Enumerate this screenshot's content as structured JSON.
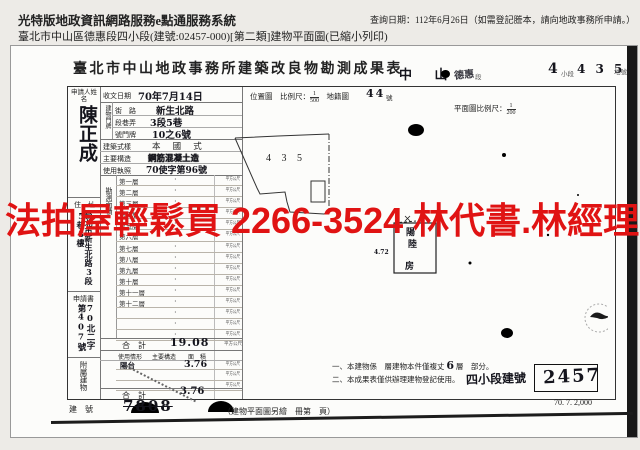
{
  "header": {
    "system_name": "光特版地政資訊網路服務e點通服務系統",
    "query_note": "查詢日期：112年6月26日（如需登記謄本，請向地政事務所申請。）",
    "doc_desc": "臺北市中山區德惠段四小段(建號:02457-000)[第二類]建物平面圖(已縮小列印)"
  },
  "watermark": {
    "text": "法拍屋輕鬆買  2266-3524  林代書.林經理",
    "color": "#e01313"
  },
  "form": {
    "title": "臺北市中山地政事務所建築改良物勘測成果表",
    "title_hand1": "中 山",
    "title_hand2": "德惠",
    "title_hand3": "段",
    "title_stamp_num1": "4",
    "title_stamp_mid": "小段",
    "title_stamp_num2": "4 3 5",
    "title_stamp_suffix": "地號",
    "applicant_label": "申請人姓名",
    "applicant_name": "陳正成",
    "address_label": "住　址",
    "address_value": "台北市新生北路3段5巷3樓",
    "application_label": "申請書",
    "application_no": "70北二字第407號",
    "annex_side_label": "附屬建物",
    "received_label": "收文日期",
    "received_value": "70年7月14日",
    "location_label": "位置圖　比例尺：",
    "location_num": "1",
    "location_den": "500",
    "map_label": "地籍圖",
    "map_no": "44",
    "map_suffix": "號",
    "plan_scale_label": "平面圖比例尺：",
    "plan_scale_num": "1",
    "plan_scale_den": "200",
    "door": {
      "group_label": "建物門牌",
      "street_label": "街　路",
      "street_value": "新生北路",
      "lane_label": "段巷弄",
      "lane_value": "3段5巷",
      "number_label": "號門牌",
      "number_value": "10之6號"
    },
    "style_label": "建築式樣",
    "style_value": "本 國 式",
    "structure_label": "主要構造",
    "structure_value": "鋼筋混凝土造",
    "license_label": "使用執照",
    "license_value": "70使字第96號",
    "area_side_label": "勘測面積",
    "floor_unit": "平方公尺",
    "floors": [
      "第一層",
      "第二層",
      "第三層",
      "第四層",
      "第五層",
      "第六層",
      "第七層",
      "第八層",
      "第九層",
      "第十層",
      "第十一層",
      "第十二層",
      "",
      "",
      ""
    ],
    "total_label": "合　計",
    "total_value": "19.08",
    "annex": {
      "headers": [
        "使用情形",
        "主要構造",
        "面　積"
      ],
      "rows": [
        {
          "use": "陽台",
          "area": "3.76"
        },
        {
          "use": "",
          "area": ""
        },
        {
          "use": "",
          "area": ""
        }
      ],
      "total_label": "合　計",
      "total_value": "3.76",
      "unit": "平方公尺"
    },
    "plan": {
      "lot_label": "4 3 5",
      "dim_label": "4.72",
      "room_char1": "陽",
      "room_char2": "陸",
      "room_char3": "房"
    },
    "notes": {
      "n1a": "一、本建物係",
      "n1b": "層建物本件僅複丈",
      "n1_hand": "6",
      "n1c": "層",
      "n1d": "部分。",
      "n2": "二、本成果表僅供辦理建物登記使用。"
    },
    "four_label": "四小段建號",
    "four_value": "2457",
    "build_no_label": "建　號",
    "build_no_value": "7808",
    "bottom_note": "（建物平面圖另繪　冊第　頁）",
    "print_code": "70. 7. 2,000"
  }
}
